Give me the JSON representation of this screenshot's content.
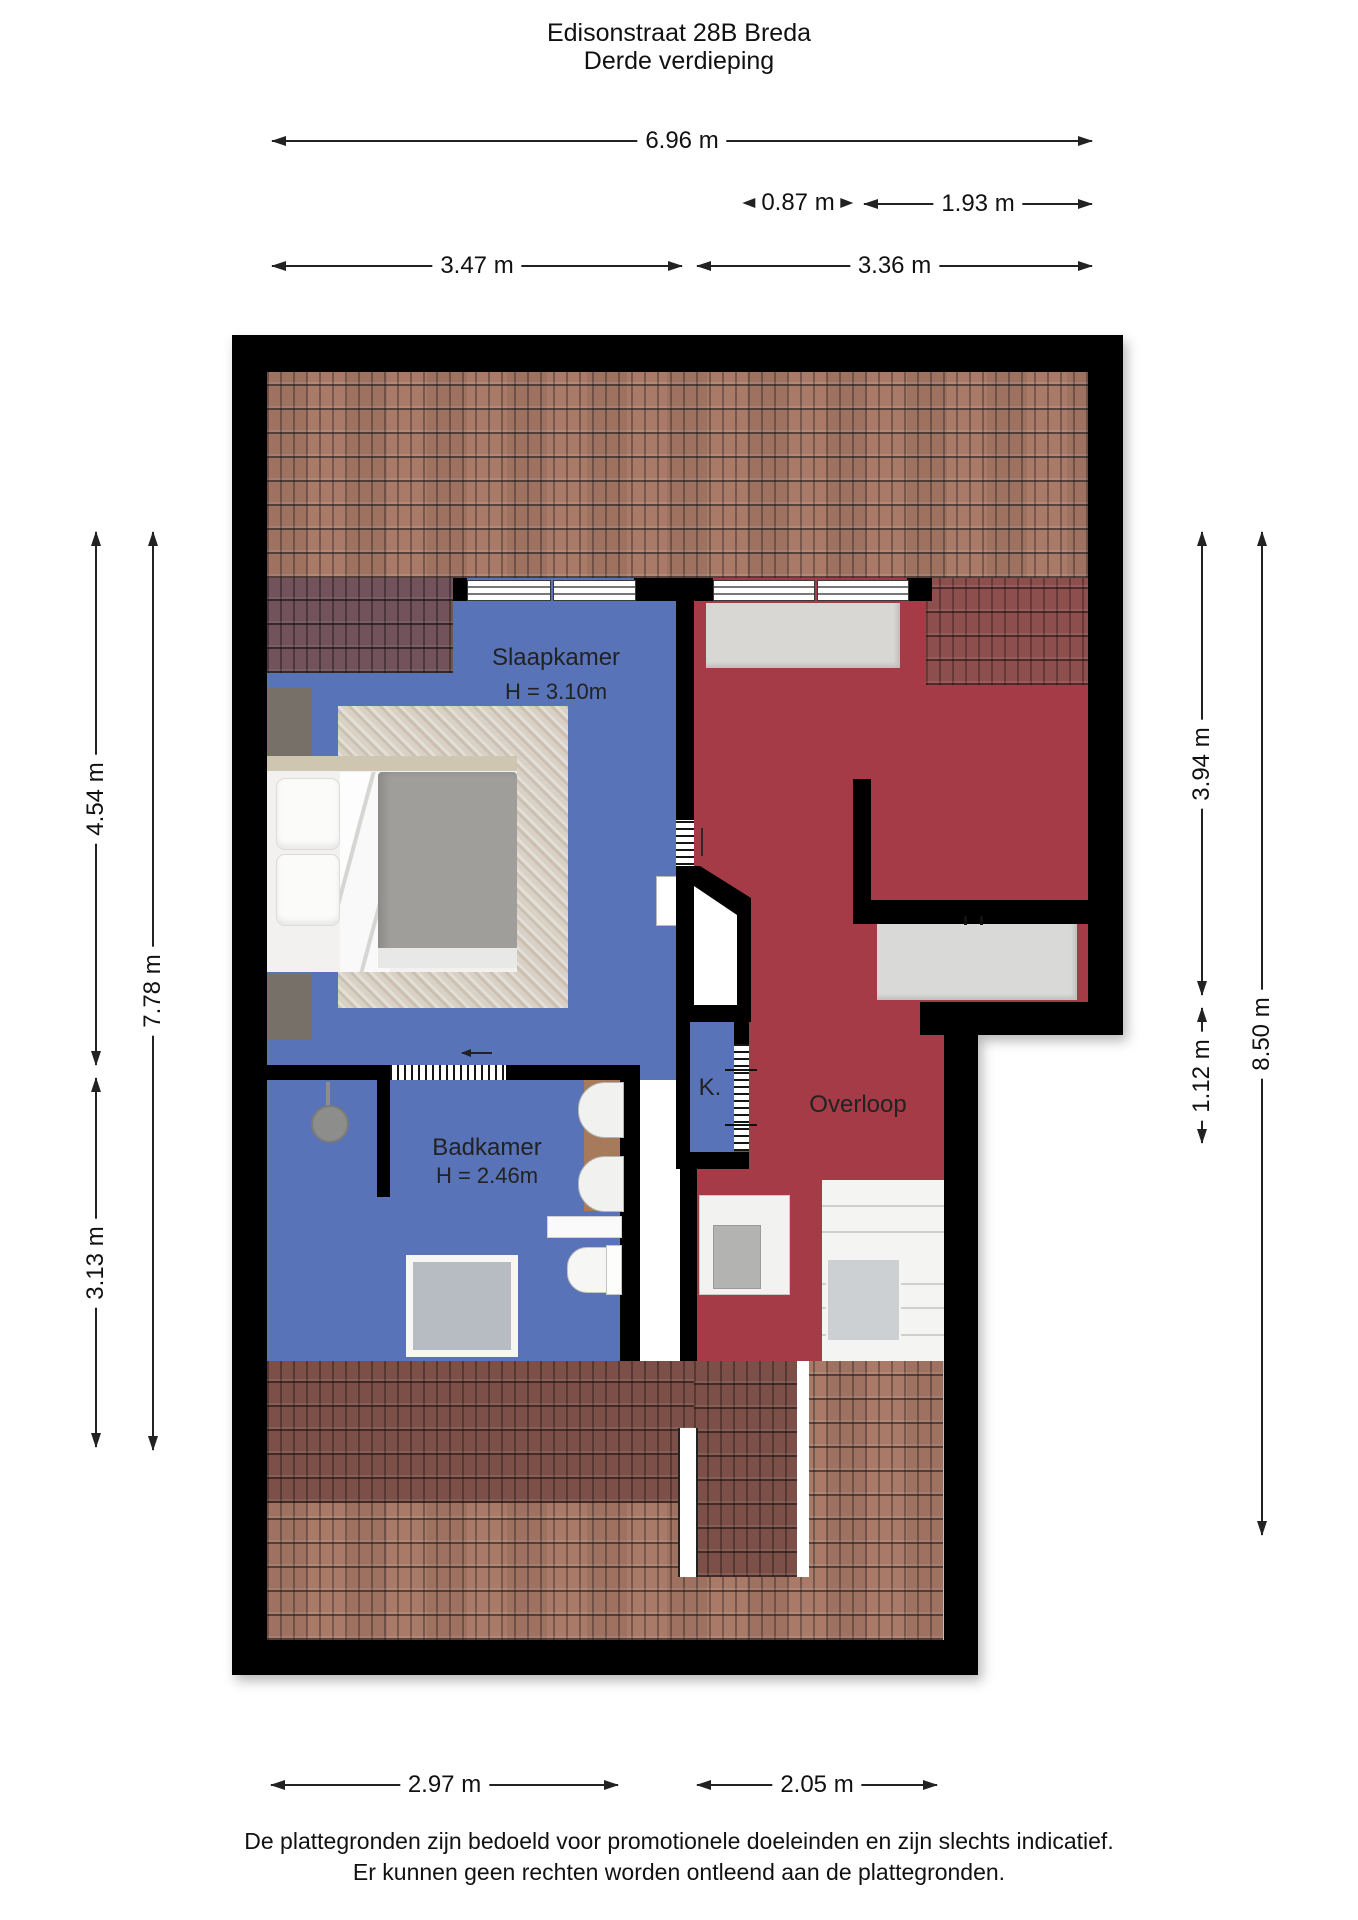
{
  "title": {
    "line1": "Edisonstraat 28B Breda",
    "line2": "Derde verdieping"
  },
  "rooms": {
    "slaapkamer": {
      "name": "Slaapkamer",
      "height": "H = 3.10m"
    },
    "badkamer": {
      "name": "Badkamer",
      "height": "H = 2.46m"
    },
    "overloop": {
      "name": "Overloop"
    },
    "kast": {
      "name": "K."
    }
  },
  "dimensions": {
    "top_total": "6.96 m",
    "top_small": "0.87 m",
    "top_small2": "1.93 m",
    "top_left": "3.47 m",
    "top_right": "3.36 m",
    "left_upper": "4.54 m",
    "left_full": "7.78 m",
    "left_lower": "3.13 m",
    "right_upper": "3.94 m",
    "right_step": "1.12 m",
    "right_full": "8.50 m",
    "bottom_left": "2.97 m",
    "bottom_right": "2.05 m"
  },
  "footer": {
    "line1": "De plattegronden zijn bedoeld voor promotionele doeleinden en zijn slechts indicatief.",
    "line2": "Er kunnen geen rechten worden ontleend aan de plattegronden."
  },
  "colors": {
    "wall": "#000000",
    "room_blue": "#5873b7",
    "room_red": "#a43b47",
    "tile_light": "#aa7a68",
    "tile_dark_overlay_left": "#72525b",
    "tile_dark_overlay_right": "#8c4f4e",
    "tile_dark_bottom": "#7c5048"
  }
}
